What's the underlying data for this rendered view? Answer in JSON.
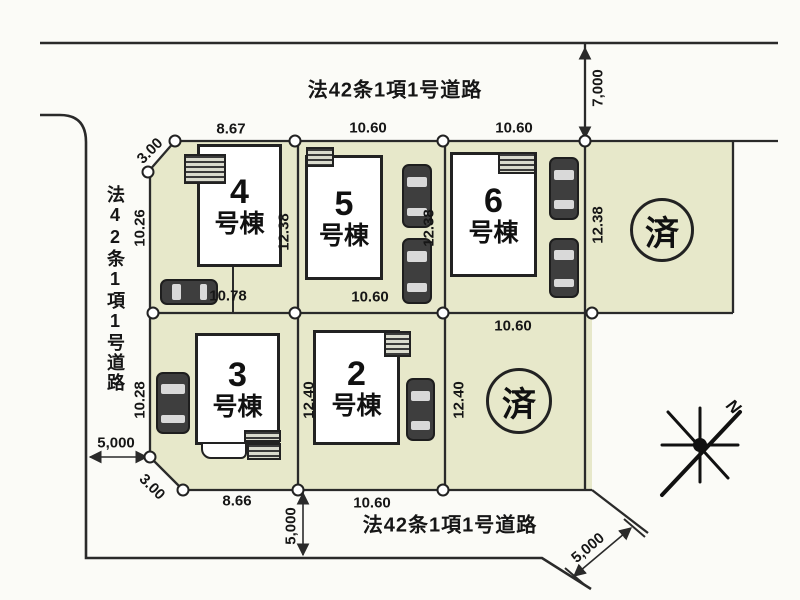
{
  "roads": {
    "top": {
      "label": "法42条1項1号道路",
      "width": "7,000"
    },
    "left": {
      "label": "法42条1項1号道路",
      "width": "5,000"
    },
    "bottom": {
      "label": "法42条1項1号道路",
      "width": "5,000",
      "width_diagonal": "5,000"
    }
  },
  "plots": [
    {
      "id": "4",
      "number": "4",
      "suffix": "号棟",
      "dim_top": "8.67",
      "dim_left": "10.26",
      "dim_right": "12.38",
      "dim_bottom": "10.78",
      "corner_cut": "3.00"
    },
    {
      "id": "5",
      "number": "5",
      "suffix": "号棟",
      "dim_top": "10.60",
      "dim_right": "12.38",
      "dim_bottom": "10.60"
    },
    {
      "id": "6",
      "number": "6",
      "suffix": "号棟",
      "dim_top": "10.60",
      "dim_right": "12.38"
    },
    {
      "id": "3",
      "number": "3",
      "suffix": "号棟",
      "dim_left": "10.28",
      "dim_bottom": "8.66",
      "corner_cut": "3.00"
    },
    {
      "id": "2",
      "number": "2",
      "suffix": "号棟",
      "dim_left": "12.40",
      "dim_bottom": "10.60"
    },
    {
      "id": "sold-top",
      "status": "済"
    },
    {
      "id": "sold-bottom",
      "status": "済",
      "dim_top": "10.60",
      "dim_left": "12.40"
    }
  ],
  "compass": {
    "north": "N"
  },
  "colors": {
    "parcel_fill": "#e7e8ca",
    "line": "#2a2a2a",
    "background": "#fbfbf7"
  }
}
